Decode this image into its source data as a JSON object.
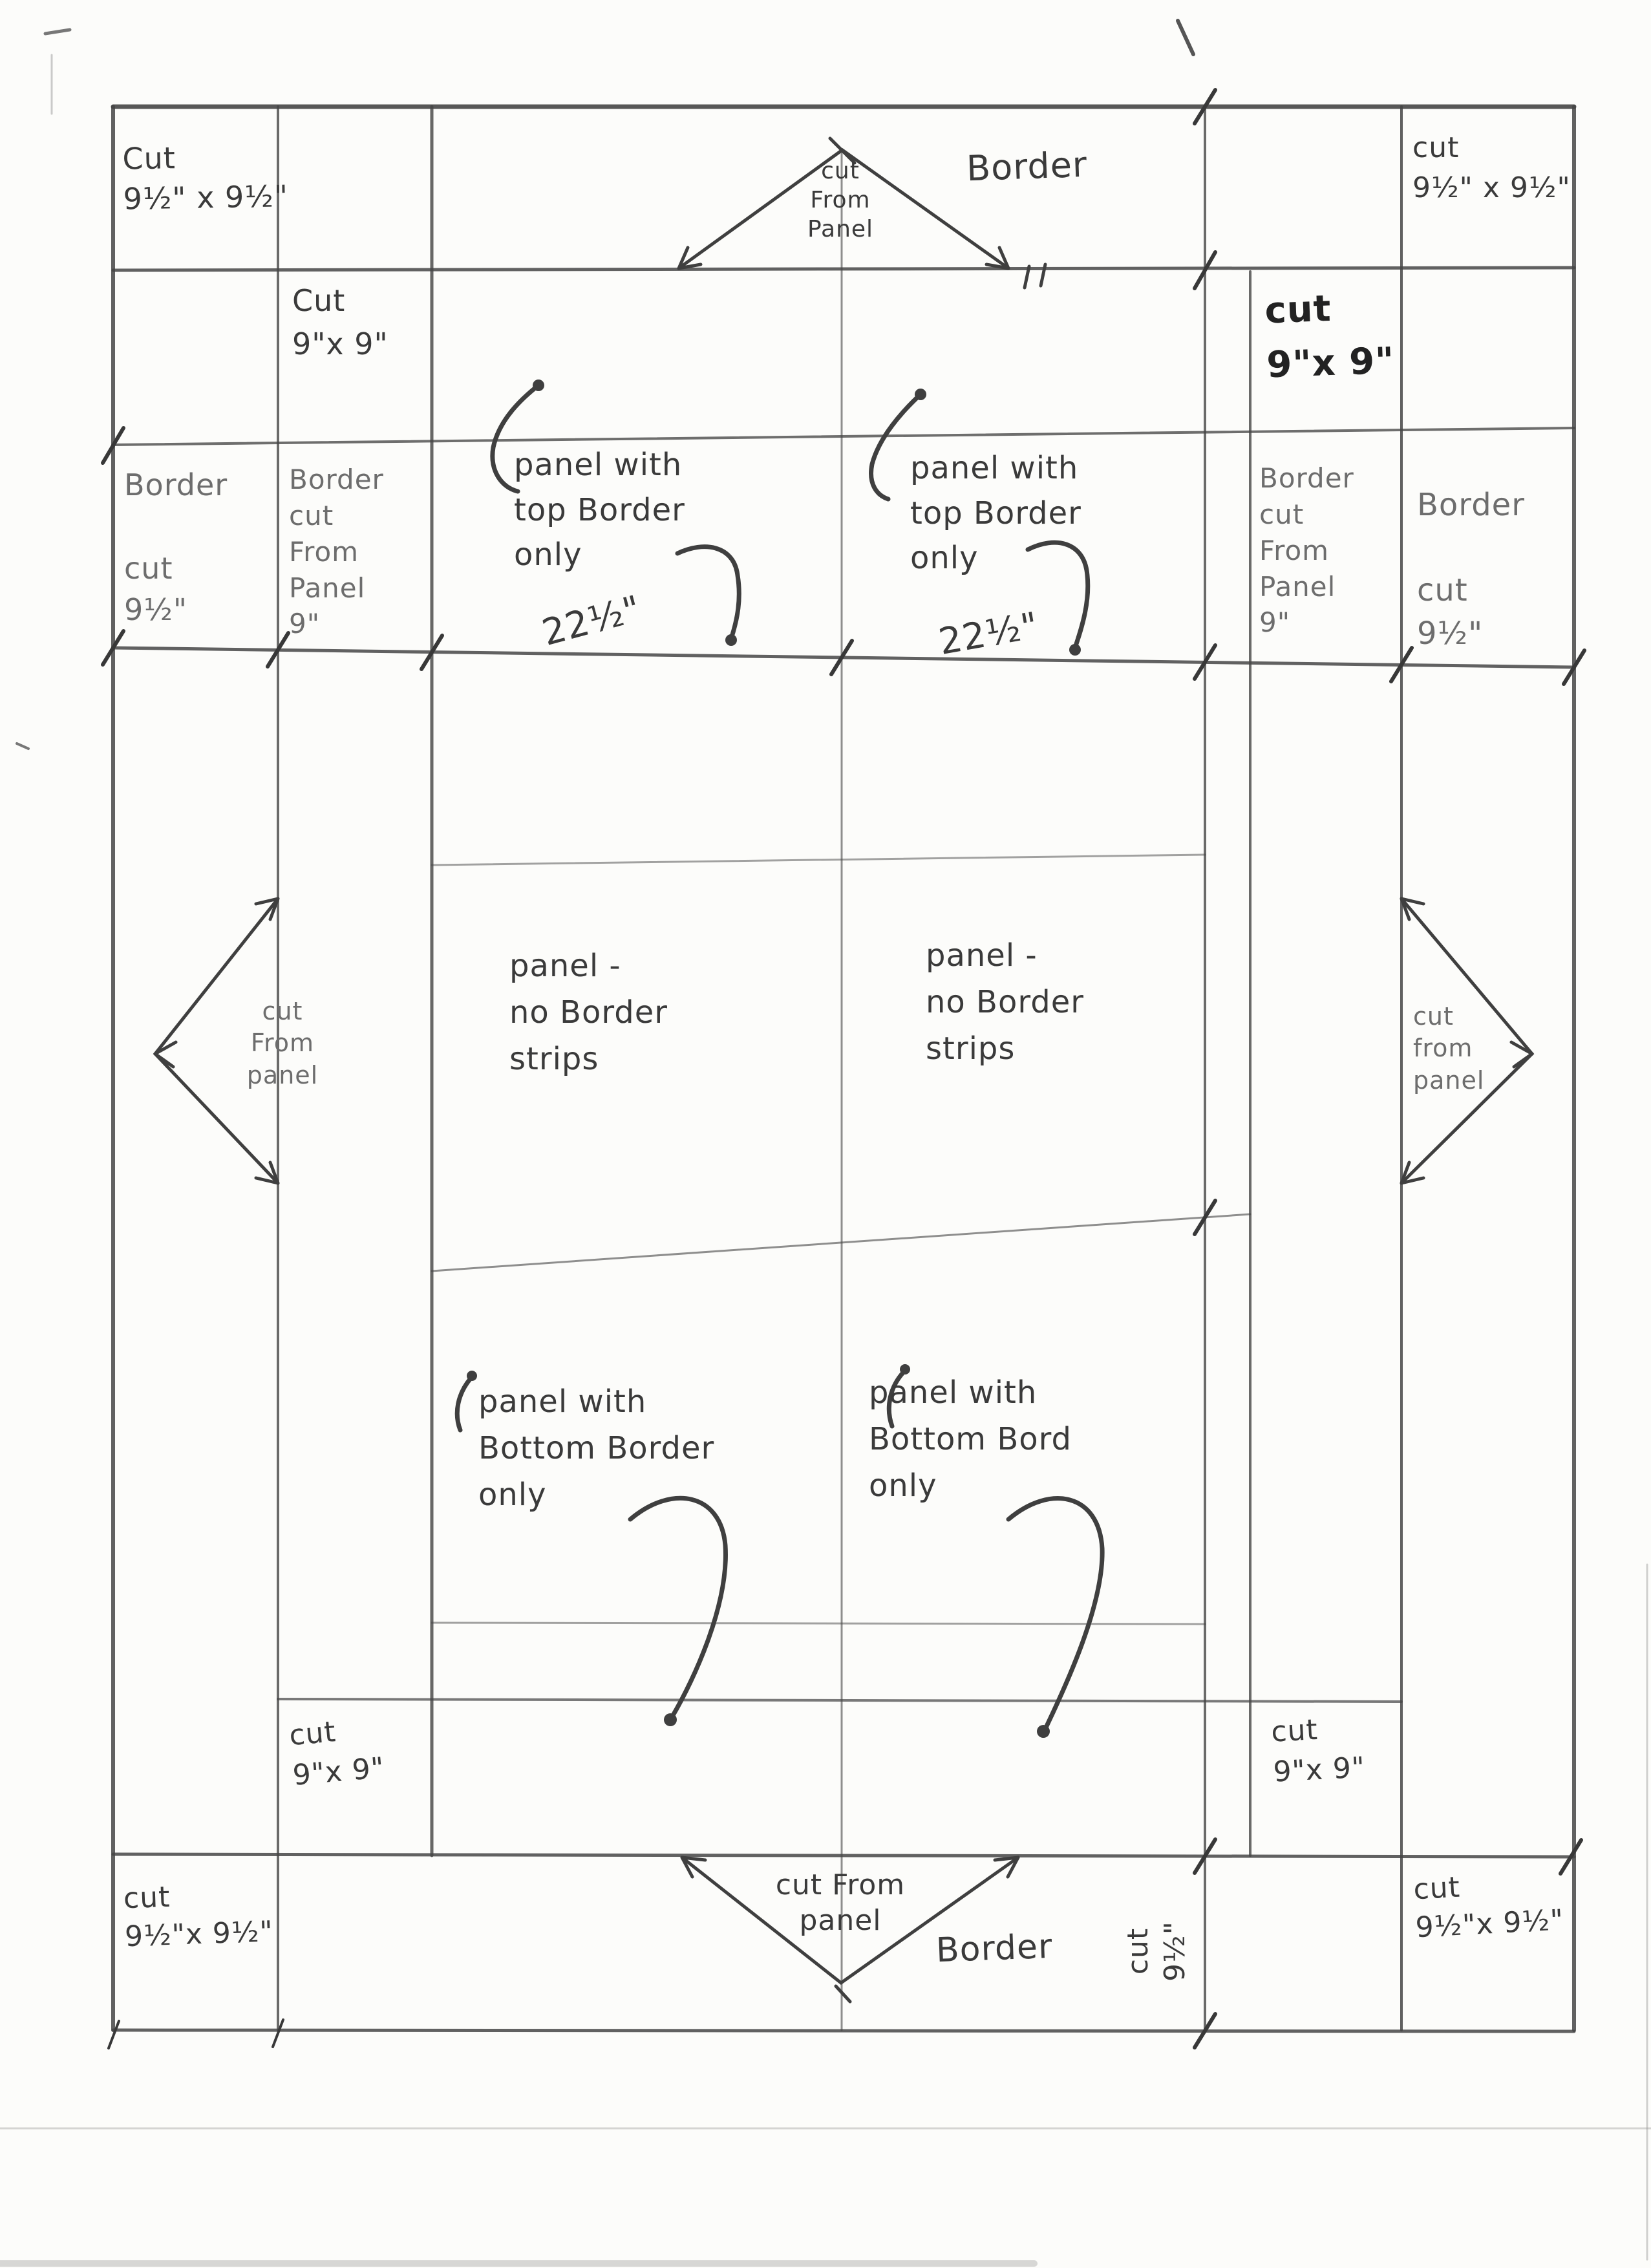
{
  "document": {
    "type": "hand-drawn quilt panel cutting diagram (pencil on paper, scanned)",
    "colors": {
      "paper": "#fcfcfa",
      "pencil_ink": "#424242",
      "light_pencil": "#6d6d6d",
      "marker_ink": "#222222"
    }
  },
  "labels": {
    "corners": {
      "tl": "Cut\n9½\" x 9½\"",
      "tr": "cut\n9½\" x 9½\"",
      "bl": "cut\n9½\"x 9½\"",
      "br": "cut\n9½\"x 9½\""
    },
    "top": {
      "border": "Border",
      "triangle": "cut\nFrom\nPanel"
    },
    "row2": {
      "left_cut": "Cut\n9\"x 9\"",
      "right_cut": "cut\n9\"x 9\""
    },
    "columns": {
      "left_outer": "Border\n\ncut\n9½\"",
      "left_inner": "Border\ncut\nFrom\nPanel\n9\"",
      "right_inner": "Border\ncut\nFrom\nPanel\n9\"",
      "right_outer": "Border\n\ncut\n9½\""
    },
    "panels": {
      "tl": {
        "caption": "panel with\ntop Border\n only",
        "width": "22½\""
      },
      "tr": {
        "caption": "panel with\ntop Border\n only",
        "width": "22½\""
      },
      "ml": {
        "caption": "panel -\nno Border\nstrips"
      },
      "mr": {
        "caption": "panel -\nno Border\nstrips"
      },
      "bl": {
        "caption": "panel with\nBottom Border\n only"
      },
      "br": {
        "caption": "panel with\nBottom Bord\n only"
      }
    },
    "side_triangles": {
      "left": "cut\nFrom\npanel",
      "right": "cut\nfrom\npanel"
    },
    "bottom_row": {
      "left_cut": "cut\n9\"x 9\"",
      "right_cut": "cut\n9\"x 9\""
    },
    "bottom": {
      "triangle": "cut From\npanel",
      "border": "Border",
      "rotated_cut": "cut\n9½\""
    }
  }
}
